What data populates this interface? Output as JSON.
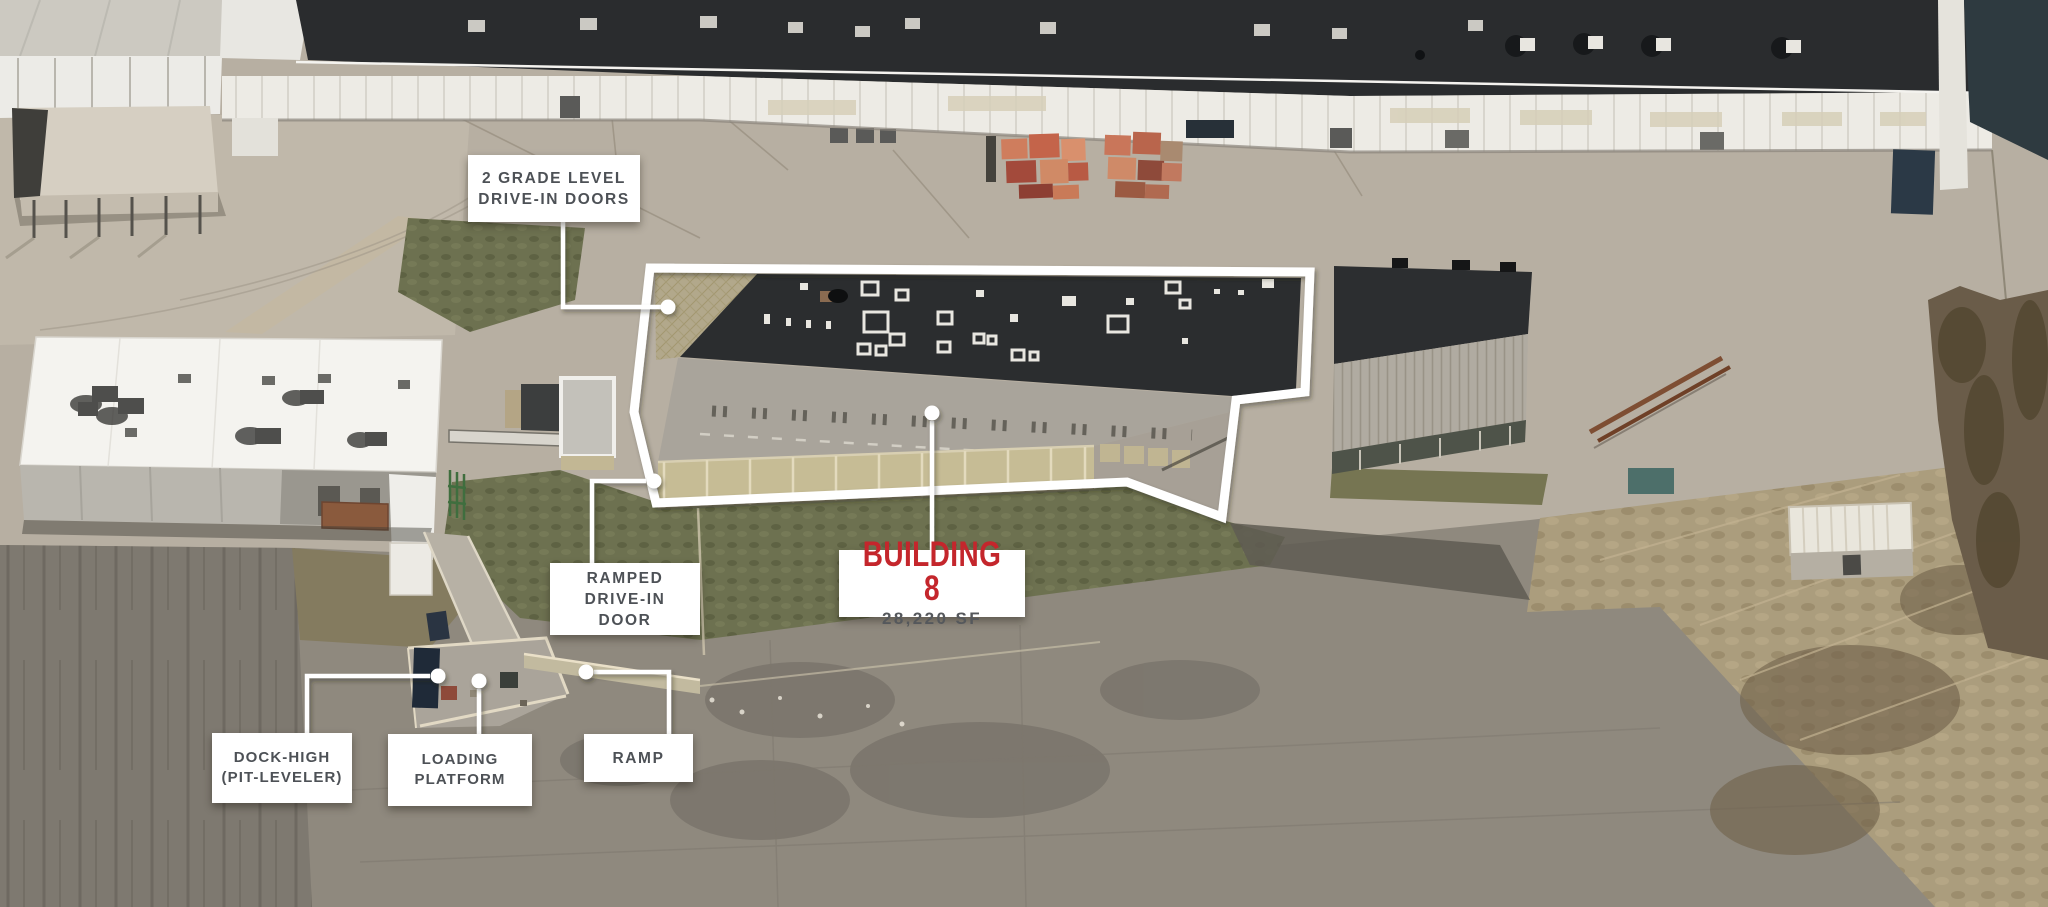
{
  "colors": {
    "accent_red": "#c4262c",
    "label_text": "#4d5156",
    "label_background": "#ffffff",
    "callout_line": "#ffffff",
    "building_outline": "#ffffff"
  },
  "callouts": {
    "grade_doors": {
      "lines": [
        "2 GRADE LEVEL",
        "DRIVE-IN DOORS"
      ]
    },
    "ramped_door": {
      "lines": [
        "RAMPED",
        "DRIVE-IN",
        "DOOR"
      ]
    },
    "building": {
      "name": "BUILDING 8",
      "area": "28,220 SF"
    },
    "dock_high": {
      "lines": [
        "DOCK-HIGH",
        "(PIT-LEVELER)"
      ]
    },
    "loading_platform": {
      "lines": [
        "LOADING",
        "PLATFORM"
      ]
    },
    "ramp": {
      "lines": [
        "RAMP"
      ]
    }
  }
}
